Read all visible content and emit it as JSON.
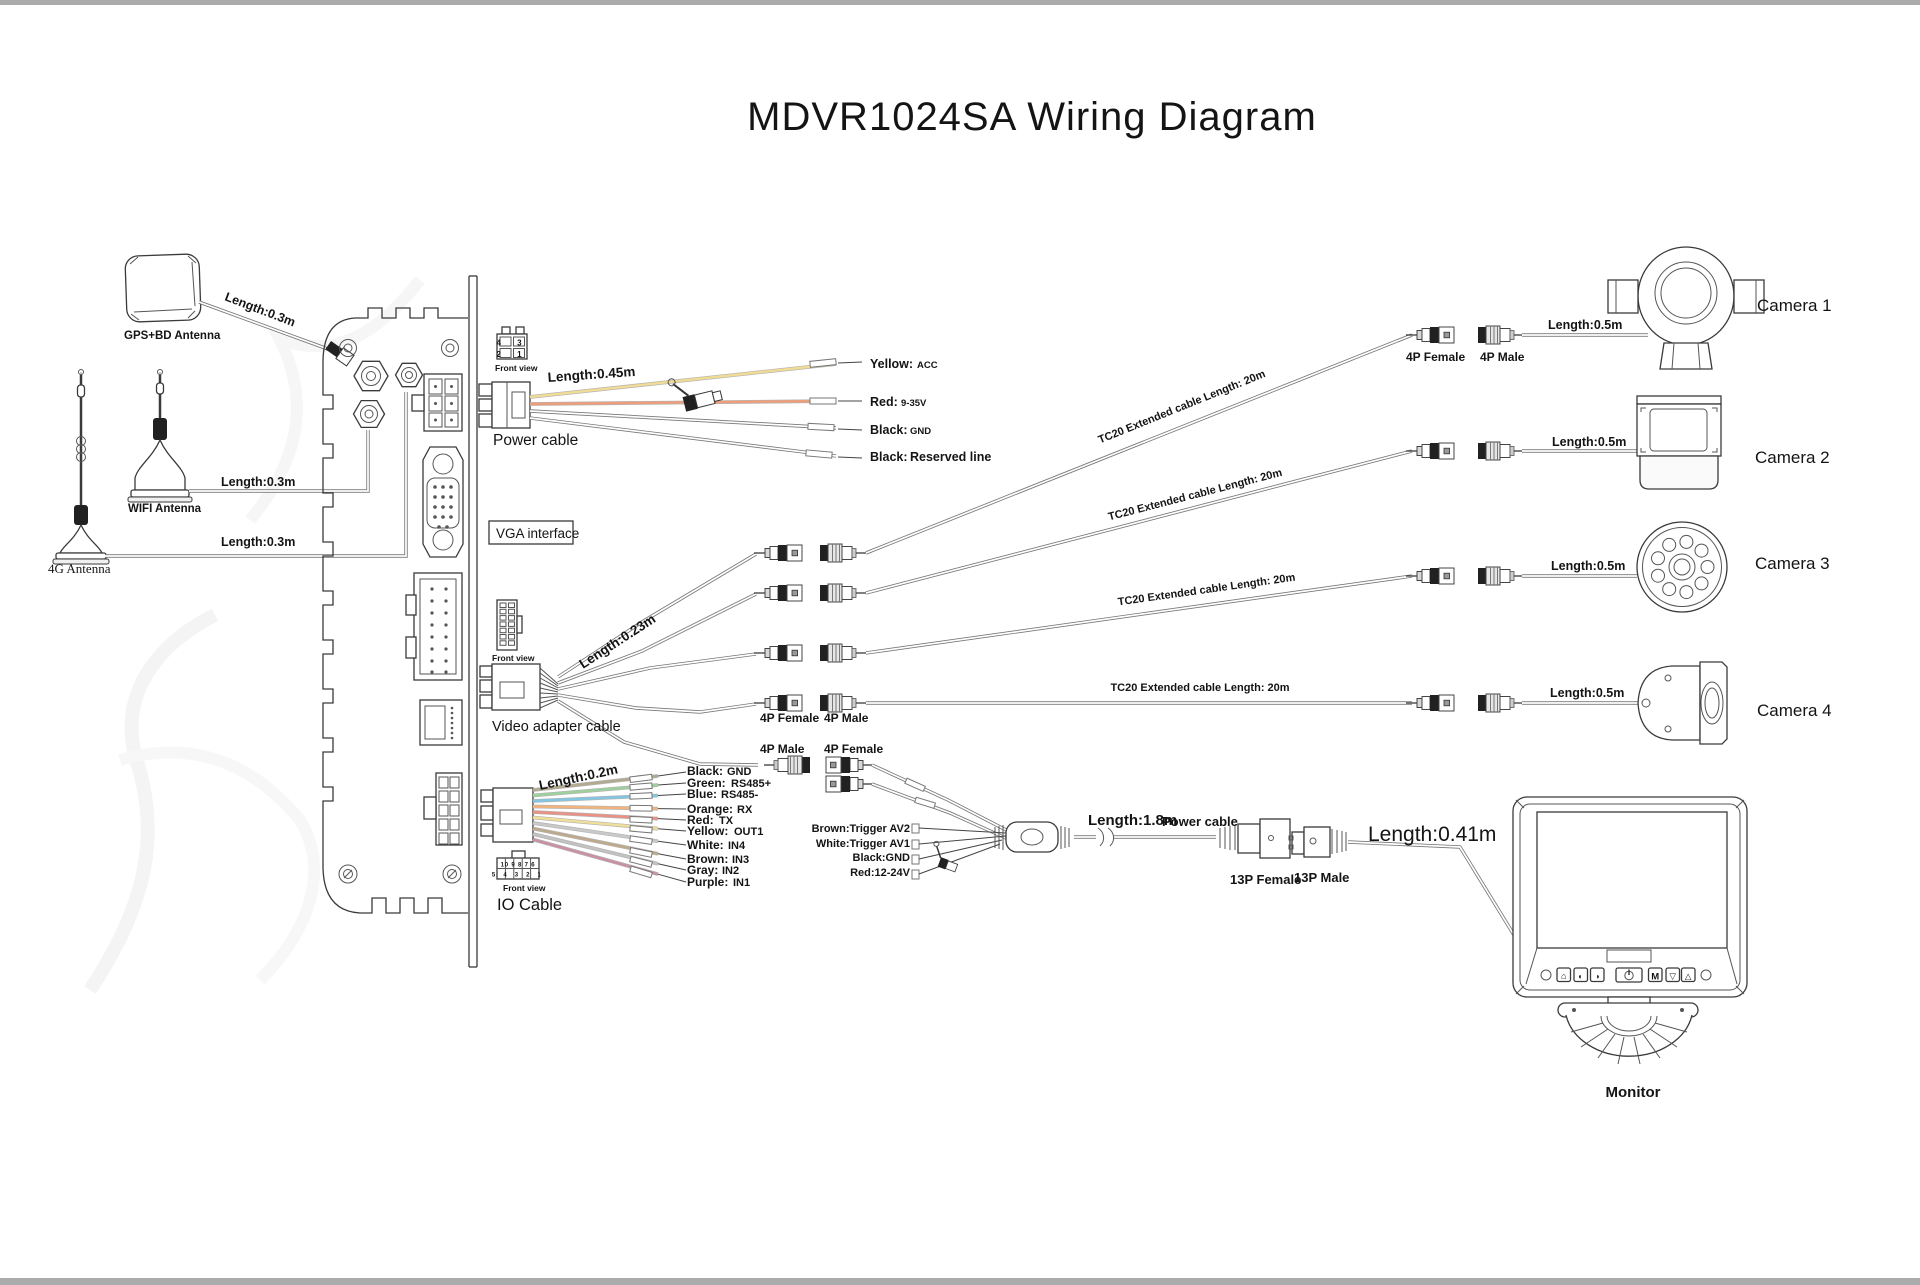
{
  "page": {
    "title": "MDVR1024SA Wiring Diagram"
  },
  "antennas": {
    "gps": {
      "label": "GPS+BD  Antenna",
      "length": "Length:0.3m"
    },
    "wifi": {
      "label": "WIFI Antenna",
      "length": "Length:0.3m"
    },
    "lte": {
      "label": "4G Antenna",
      "length": "Length:0.3m"
    }
  },
  "device": {
    "power_cable": {
      "front_view": "Front view",
      "pins_top": "4 3",
      "pins_bottom": "2 1",
      "length": "Length:0.45m",
      "label": "Power cable",
      "wires": [
        {
          "label": "Yellow:",
          "signal": "ACC",
          "color": "#f1dc95"
        },
        {
          "label": "Red:",
          "signal": "9-35V",
          "color": "#ee9e7a"
        },
        {
          "label": "Black:",
          "signal": "GND",
          "color": "#a9a9a9"
        },
        {
          "label": "Black:",
          "signal": "Reserved line",
          "color": "#a9a9a9"
        }
      ]
    },
    "vga": {
      "label": "VGA interface"
    },
    "video_adapter": {
      "front_view": "Front view",
      "length": "Length:0.23m",
      "label": "Video adapter cable"
    },
    "io_cable": {
      "front_view": "Front view",
      "pins_top": "10 9 8 7 6",
      "pins_bottom": "5 4 3 2 1",
      "length": "Length:0.2m",
      "label": "IO Cable",
      "wires": [
        {
          "label": "Black:",
          "signal": "GND",
          "color": "#b3a98e"
        },
        {
          "label": "Green:",
          "signal": "RS485+",
          "color": "#9ed09e"
        },
        {
          "label": "Blue:",
          "signal": "RS485-",
          "color": "#84c6e2"
        },
        {
          "label": "Orange:",
          "signal": "RX",
          "color": "#f2b47e"
        },
        {
          "label": "Red:",
          "signal": "TX",
          "color": "#eb9184"
        },
        {
          "label": "Yellow:",
          "signal": "OUT1",
          "color": "#efdf9a"
        },
        {
          "label": "White:",
          "signal": "IN4",
          "color": "#c9c9c9"
        },
        {
          "label": "Brown:",
          "signal": "IN3",
          "color": "#bfa98b"
        },
        {
          "label": "Gray:",
          "signal": "IN2",
          "color": "#c2c2c2"
        },
        {
          "label": "Purple:",
          "signal": "IN1",
          "color": "#cb8fa5"
        }
      ]
    }
  },
  "camera_links": {
    "female": "4P Female",
    "male": "4P Male",
    "tc20": "TC20 Extended cable  Length: 20m",
    "pigtail": "Length:0.5m",
    "cameras": [
      {
        "label": "Camera 1"
      },
      {
        "label": "Camera 2"
      },
      {
        "label": "Camera 3"
      },
      {
        "label": "Camera 4"
      }
    ]
  },
  "monitor_link": {
    "male": "4P Male",
    "female": "4P Female",
    "triggers": [
      {
        "label": "Brown:Trigger AV2"
      },
      {
        "label": "White:Trigger AV1"
      },
      {
        "label": "Black:GND"
      },
      {
        "label": "Red:12-24V"
      }
    ],
    "length": "Length:1.8m",
    "power_cable": "Power cable",
    "female13": "13P Female",
    "male13": "13P Male",
    "monitor_cable_length": "Length:0.41m",
    "monitor": {
      "label": "Monitor",
      "buttons": [
        {
          "icon": "home-icon",
          "glyph": "⌂"
        },
        {
          "icon": "brightness-down-icon",
          "glyph": "◐"
        },
        {
          "icon": "brightness-up-icon",
          "glyph": "◑"
        },
        {
          "icon": "power-icon",
          "glyph": ""
        },
        {
          "icon": "menu-button",
          "glyph": "M"
        },
        {
          "icon": "down-button",
          "glyph": "▽"
        },
        {
          "icon": "up-button",
          "glyph": "△"
        }
      ]
    }
  }
}
